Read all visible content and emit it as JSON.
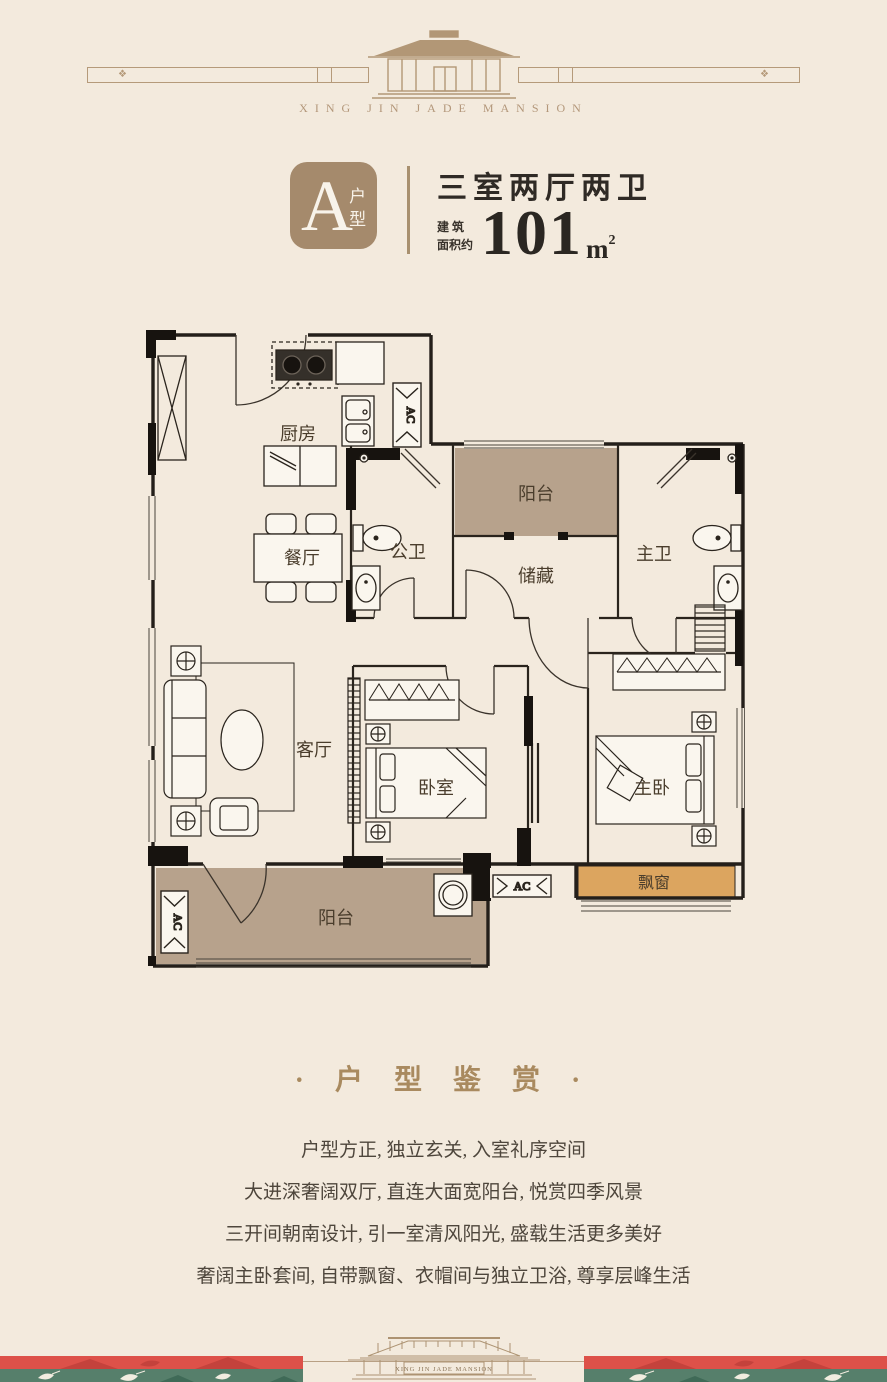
{
  "header": {
    "brand": "XING JIN JADE MANSION",
    "ornament": "❖"
  },
  "unit": {
    "badge_letter": "A",
    "badge_suffix": "户型",
    "layout_title": "三室两厅两卫",
    "area_prefix_line1": "建 筑",
    "area_prefix_line2": "面积约",
    "area_value": "101",
    "area_unit": "m",
    "area_exponent": "2"
  },
  "floor_plan": {
    "rooms": {
      "kitchen": "厨房",
      "dining": "餐厅",
      "public_bath": "公卫",
      "balcony_top": "阳台",
      "storage": "储藏",
      "master_bath": "主卫",
      "living": "客厅",
      "bedroom": "卧室",
      "master_bedroom": "主卧",
      "bay_window": "飘窗",
      "balcony_bottom": "阳台"
    },
    "ac_label": "AC"
  },
  "showcase": {
    "title": "· 户 型 鉴 赏 ·",
    "lines": [
      "户型方正, 独立玄关, 入室礼序空间",
      "大进深奢阔双厅, 直连大面宽阳台, 悦赏四季风景",
      "三开间朝南设计, 引一室清风阳光, 盛载生活更多美好",
      "奢阔主卧套间, 自带飘窗、衣帽间与独立卫浴, 尊享层峰生活"
    ]
  },
  "footer": {
    "brand": "XING JIN JADE MANSION"
  },
  "colors": {
    "background": "#f3eadd",
    "accent_tan": "#a58a6c",
    "brand_tan": "#b3977a",
    "balcony_fill": "#b7a28c",
    "bay_window_fill": "#dca55f",
    "band_red": "#dd5149",
    "band_green": "#567f6b",
    "wall_dark": "#17130f",
    "title_text": "#2f2a25",
    "body_text": "#4e463c"
  }
}
